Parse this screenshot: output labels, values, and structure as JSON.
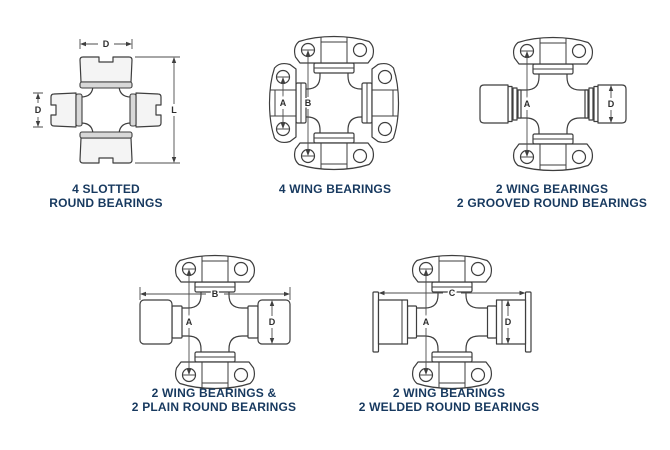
{
  "page": {
    "background": "#ffffff"
  },
  "colors": {
    "caption_text": "#17395f",
    "line_art": "#3e3e3e",
    "dimension_lines": "#4d4d4d",
    "bearing_shade": "#d8d8d8"
  },
  "diagrams": [
    {
      "id": "4-slotted-round-bearings",
      "caption_lines": [
        "4 SLOTTED",
        "ROUND BEARINGS"
      ],
      "dims": {
        "bearing_diameter_top": "D",
        "bearing_diameter_left": "D",
        "overall_length": "L"
      }
    },
    {
      "id": "4-wing-bearings",
      "caption_lines": [
        "4 WING BEARINGS"
      ],
      "dims": {
        "hole_span_inner": "A",
        "hole_span_outer": "B"
      }
    },
    {
      "id": "2-wing-2-grooved-round-bearings",
      "caption_lines": [
        "2 WING BEARINGS",
        "2 GROOVED ROUND BEARINGS"
      ],
      "dims": {
        "hole_span": "A",
        "bearing_diameter": "D"
      }
    },
    {
      "id": "2-wing-2-plain-round-bearings",
      "caption_lines": [
        "2 WING BEARINGS &",
        "2 PLAIN ROUND BEARINGS"
      ],
      "dims": {
        "overall_width": "B",
        "hole_span": "A",
        "bearing_diameter": "D"
      }
    },
    {
      "id": "2-wing-2-welded-round-bearings",
      "caption_lines": [
        "2 WING BEARINGS",
        "2 WELDED ROUND BEARINGS"
      ],
      "dims": {
        "overall_width": "C",
        "hole_span": "A",
        "bearing_diameter": "D"
      }
    }
  ]
}
